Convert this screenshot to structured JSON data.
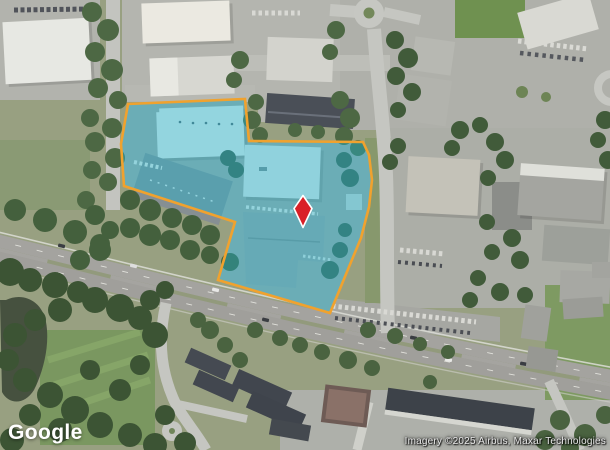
{
  "branding": {
    "logo_text": "Google"
  },
  "attribution": {
    "text": "Imagery ©2025 Airbus, Maxar Technologies"
  },
  "map": {
    "view_type": "satellite",
    "parcel_overlay": {
      "points": "128,104 245,99 249,141 363,142 369,155 372,180 369,207 361,238 351,262 330,313 218,280 235,222 124,186 121,144",
      "fill_color": "#1fb6d2",
      "fill_opacity": "0.42",
      "border_color": "#f0a22e",
      "border_width": "2.6"
    },
    "marker": {
      "x": "303",
      "y": "211",
      "color": "#d92027",
      "outline_color": "#ffffff"
    }
  }
}
